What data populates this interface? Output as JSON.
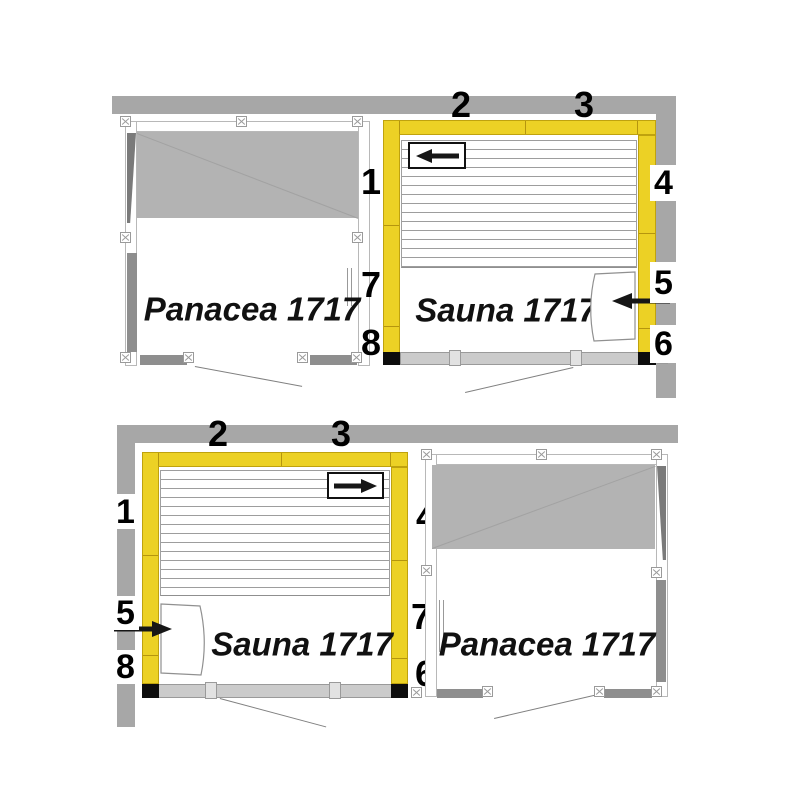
{
  "colors": {
    "frame_yellow": "#ecd125",
    "building_wall_gray": "#a7a7a7",
    "panel_shade_gray": "#b3b3b3",
    "cabin_wall_segment_gray": "#8e8e8e",
    "floor_strip_gray": "#cbcbcb",
    "corner_black": "#0d0d0d"
  },
  "icons": {
    "direction_left": "arrow-left-icon",
    "direction_right": "arrow-right-icon",
    "corner_connector": "corner-connector-icon"
  },
  "diagrams": {
    "top": {
      "panacea_label": "Panacea 1717",
      "sauna_label": "Sauna 1717",
      "numbers": {
        "1": "1",
        "2": "2",
        "3": "3",
        "4": "4",
        "5": "5",
        "6": "6",
        "7": "7",
        "8": "8"
      }
    },
    "bottom": {
      "panacea_label": "Panacea 1717",
      "sauna_label": "Sauna 1717",
      "numbers": {
        "1": "1",
        "2": "2",
        "3": "3",
        "4": "4",
        "5": "5",
        "6": "6",
        "7": "7",
        "8": "8"
      }
    }
  }
}
